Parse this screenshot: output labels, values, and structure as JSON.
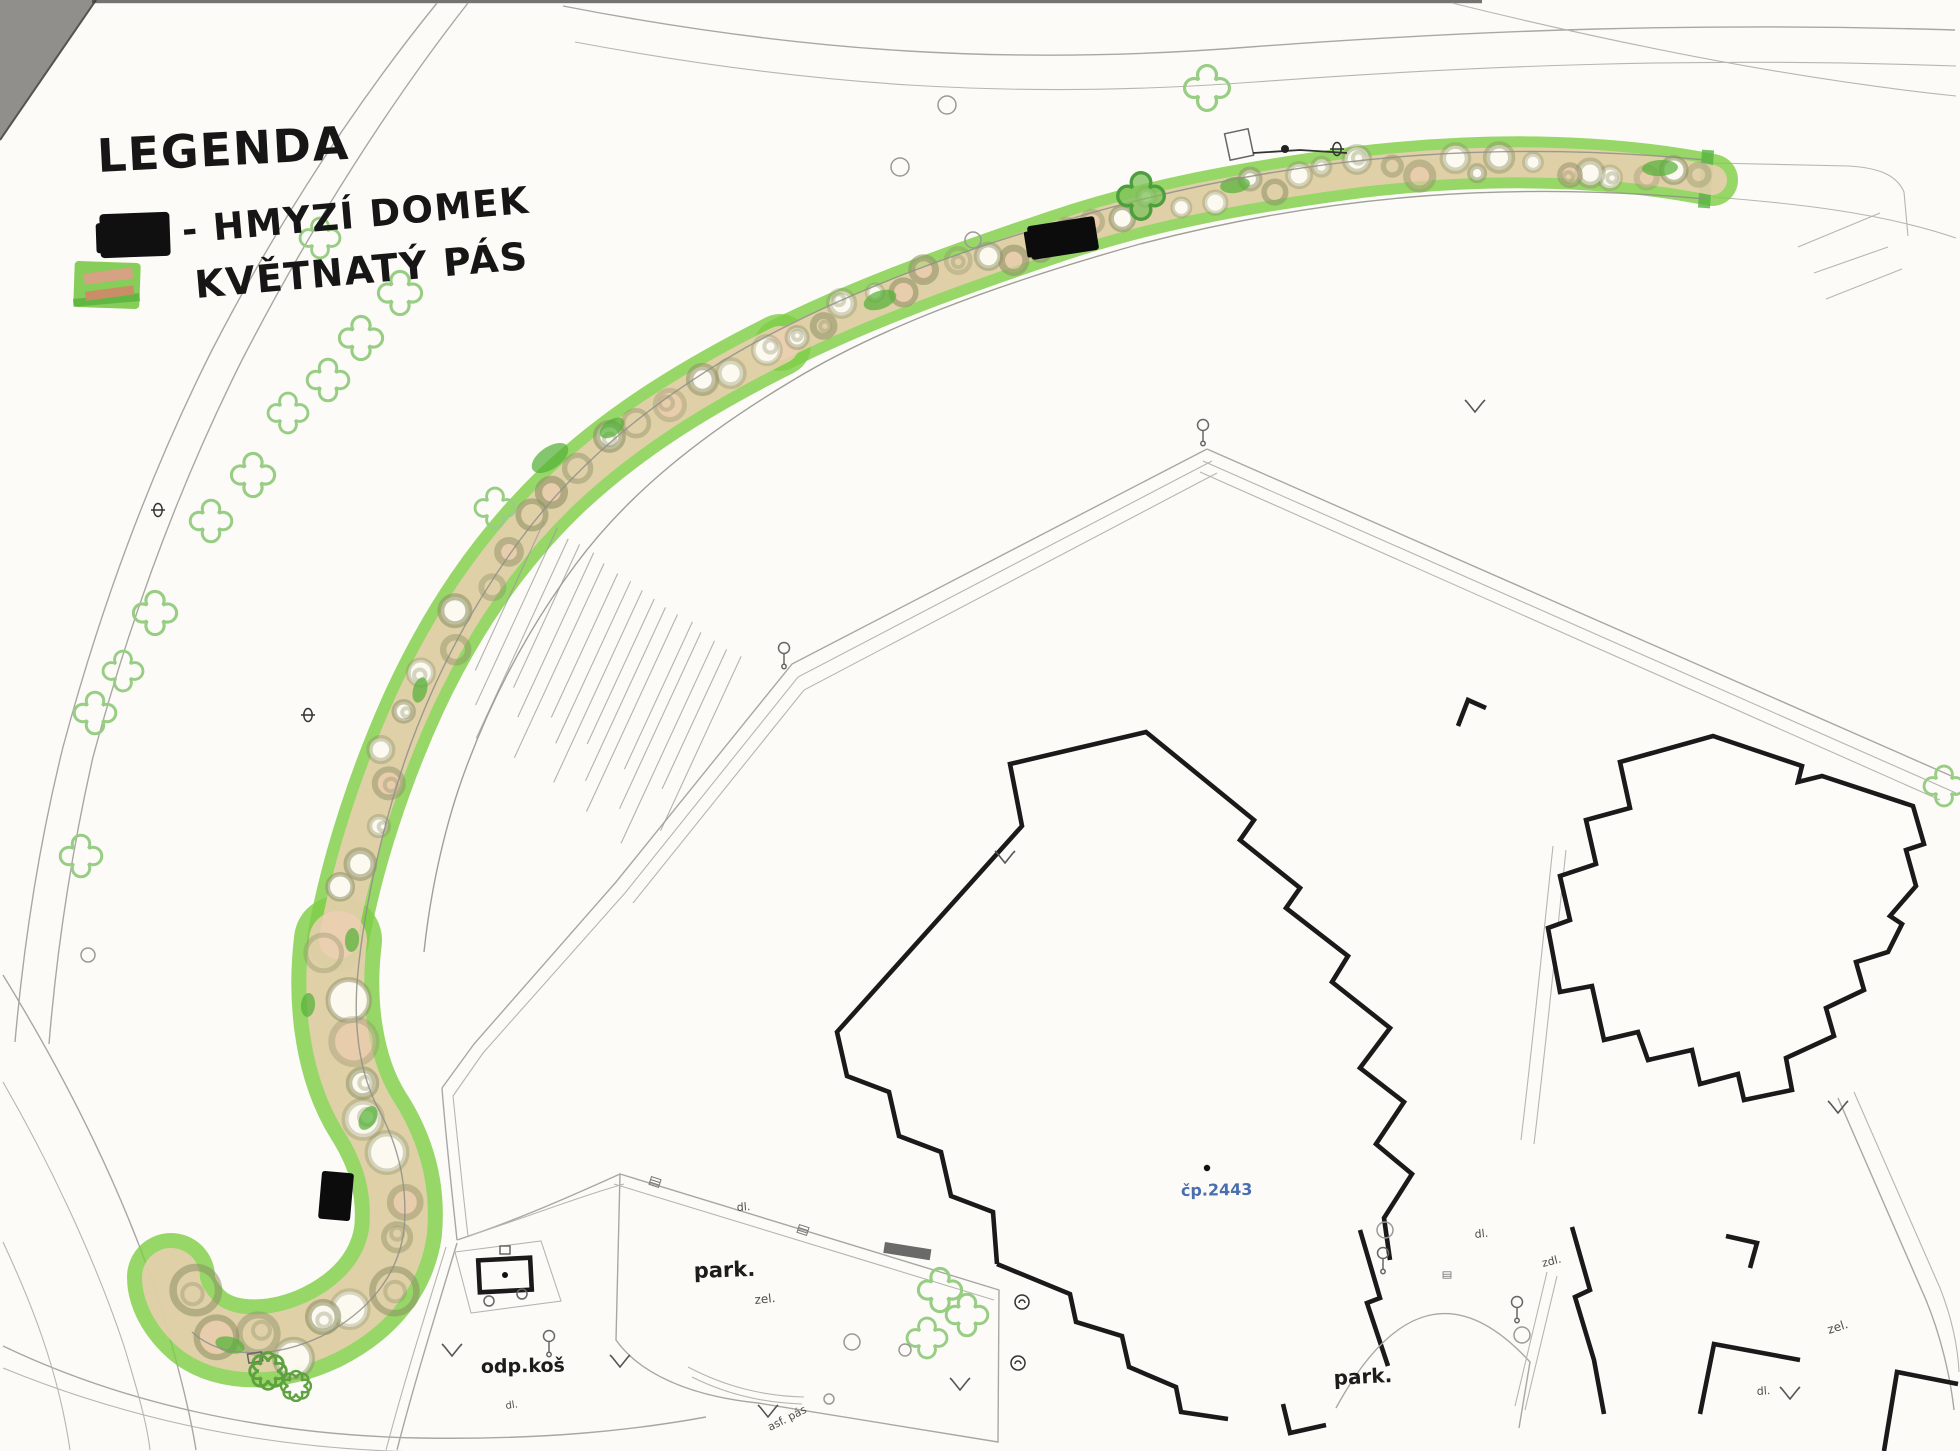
{
  "legend": {
    "title": "LEGENDA",
    "items": [
      {
        "symbol": "insect-house-swatch",
        "label": "- HMYZÍ DOMEK"
      },
      {
        "symbol": "flower-strip-swatch",
        "label": "KVĚTNATÝ PÁS"
      }
    ]
  },
  "labels": {
    "building_no": "čp.2443",
    "park_left": "park.",
    "park_right": "park.",
    "waste_bin": "odp.koš",
    "green_parking": "zel.",
    "green_right": "zel.",
    "paving_parking": "dl.",
    "paving_courtyard": "dl.",
    "paving_right": "dl.",
    "paving_road": "dl.",
    "utility_ramp": "zdl.",
    "asphalt_strip": "asf. pás"
  },
  "colors": {
    "flower_strip_green": "#7fce48",
    "flower_strip_core_tan": "#eccfb4",
    "dark_green_accent": "#54b238",
    "tree_symbol_green": "#98cd84",
    "building_outline": "#1a1a1a",
    "survey_line_gray": "#a8a8a3",
    "building_number_blue": "#4a6fae",
    "paper": "#fcfbf8"
  }
}
